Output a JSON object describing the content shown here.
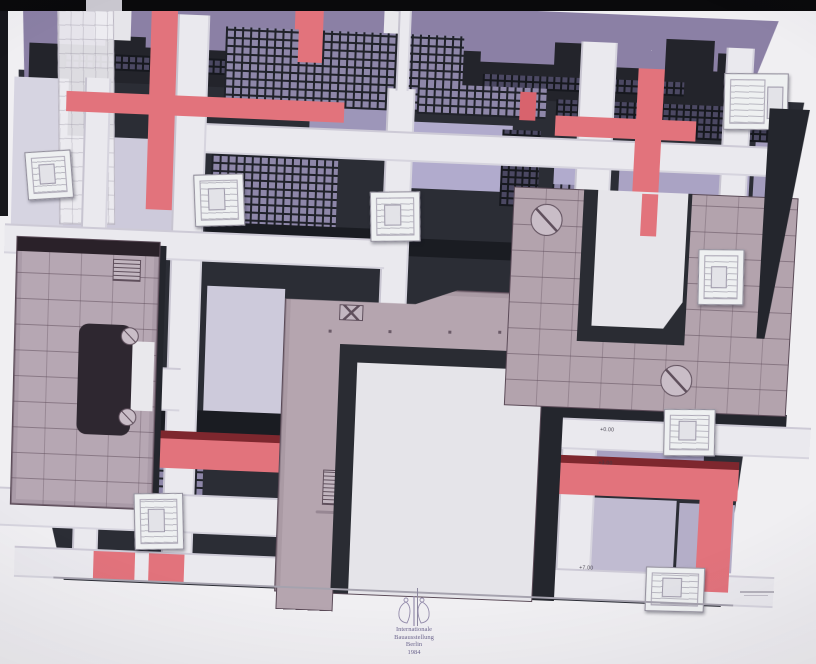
{
  "artwork": {
    "description": "IBA Berlin 1984 site plan drawing",
    "title_block": {
      "lines": [
        "Internationale",
        "Bauausstellung",
        "Berlin",
        "1984"
      ]
    },
    "annotations": {
      "level_marks": [
        "+0.00",
        "+3.00",
        "+7.00"
      ]
    },
    "palette": {
      "paper": "#f0eff2",
      "film_bar": "#0a0a0c",
      "street_white": "#eae9ee",
      "purple_band": "#8b80a5",
      "lavender": "#a8a1c2",
      "pale_lavender": "#cdcadb",
      "dark_block": "#2b2d35",
      "red_path": "#e2737c",
      "dark_red": "#7e272e",
      "plan_mauve": "#b5a5af",
      "plan_line": "#5a4a57",
      "courtyard": "#e5e4e9"
    }
  }
}
